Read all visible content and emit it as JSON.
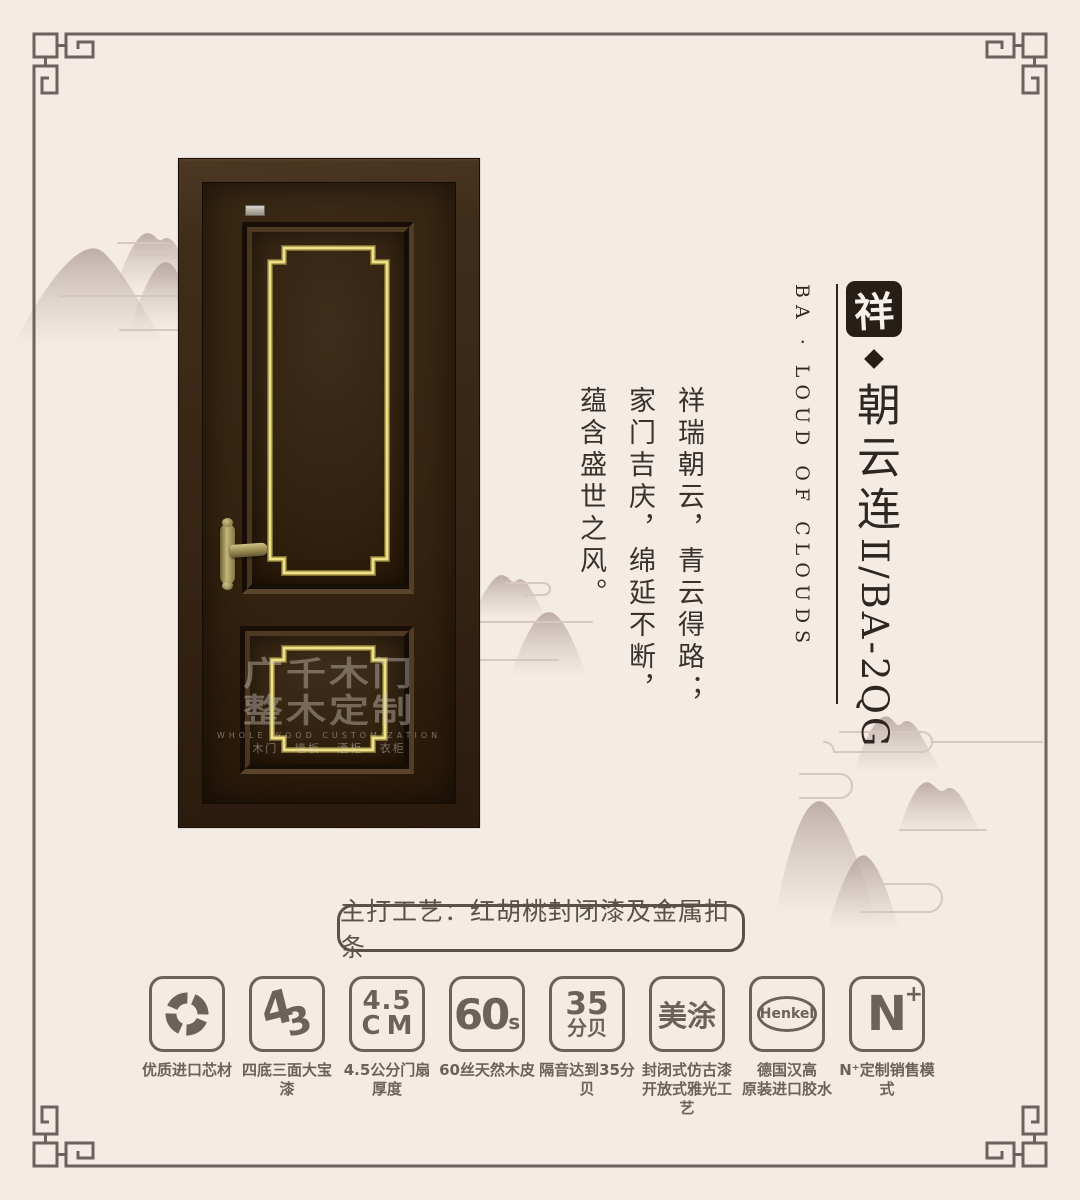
{
  "page": {
    "background": "#f3ebe4",
    "frame_color": "#6e625e",
    "accent_gold": "#efe187",
    "door_brown": "#362514",
    "ink_color": "#2e2621"
  },
  "brand": {
    "logo_char": "祥",
    "english": "BA · LOUD OF CLOUDS",
    "name_cn": "朝云连",
    "name_code": "Ⅱ/BA-2QG",
    "diamond_icon": "diamond"
  },
  "poem": {
    "text": "祥瑞朝云，青云得路；家门吉庆，绵延不断，蕴含盛世之风。"
  },
  "door": {
    "watermark": {
      "line1": "广千木门",
      "line2": "整木定制",
      "line3": "WHOLE WOOD CUSTOMIZATION",
      "line4": "木门 · 墙板 · 酒柜 · 衣柜"
    }
  },
  "banner": {
    "text": "主打工艺：红胡桃封闭漆及金属扣条"
  },
  "features": [
    {
      "icon": "aperture-icon",
      "label": "优质进口芯材"
    },
    {
      "glyph_a": "4",
      "glyph_b": "3",
      "label": "四底三面大宝漆"
    },
    {
      "glyph_top": "4.5",
      "glyph_bottom": "CM",
      "label": "4.5公分门扇厚度"
    },
    {
      "glyph_main": "60",
      "glyph_sub": "s",
      "label": "60丝天然木皮"
    },
    {
      "glyph_top": "35",
      "glyph_bottom": "分贝",
      "label": "隔音达到35分贝"
    },
    {
      "glyph_main": "美涂",
      "label": "封闭式仿古漆\n开放式雅光工艺"
    },
    {
      "glyph_main": "Henkel",
      "label": "德国汉高\n原装进口胶水"
    },
    {
      "glyph_main": "N",
      "glyph_sup": "+",
      "label": "N⁺定制销售模式"
    }
  ]
}
